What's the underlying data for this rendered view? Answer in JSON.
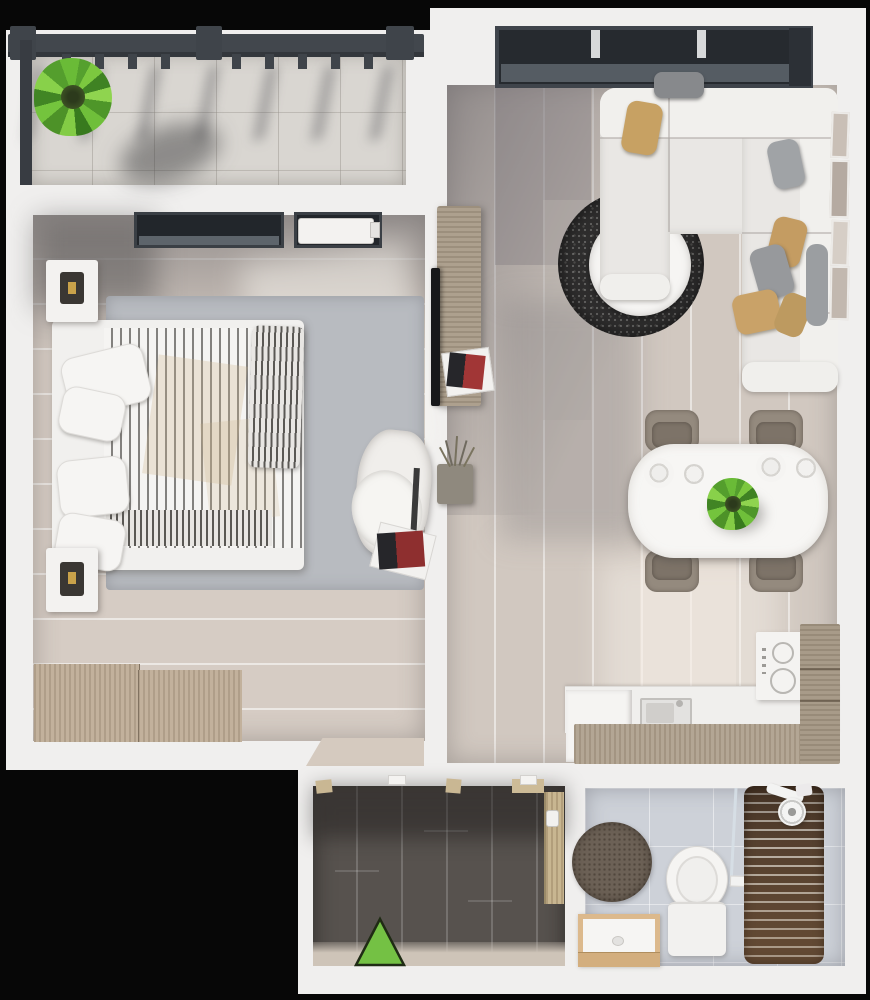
{
  "scene": {
    "kind": "3d-top-down-apartment-floor-plan",
    "background_color": "#070707",
    "wall_color": "#f0efee",
    "no_visible_text": true
  },
  "legend": {
    "entrance_marker": {
      "icon": "entrance-triangle-icon",
      "shape": "triangle-up",
      "fill": "#74c144",
      "outline": "#1f2b14"
    }
  },
  "rooms": {
    "balcony": {
      "floor_color": "#d9d6d1",
      "railing_color": "#42474d",
      "items": [
        "potted-plant",
        "railing",
        "tile-floor"
      ]
    },
    "bedroom": {
      "floor_color": "#d6ccc4",
      "rug_color": "#b8bbc0",
      "items": [
        "double-bed-striped-duvet",
        "pillows",
        "headboard",
        "nightstand-with-lamp-top",
        "nightstand-with-lamp-bottom",
        "wardrobe",
        "window-with-radiator",
        "armchair-with-throw",
        "magazine-stack"
      ]
    },
    "living_room": {
      "floor_color": "#d1c8c0",
      "items": [
        "panoramic-window",
        "corner-sofa",
        "throw-pillows-tan-and-gray",
        "round-black-rug",
        "round-white-coffee-table",
        "houseplant",
        "tv-sideboard",
        "tv",
        "decor-planter",
        "picture-frames"
      ]
    },
    "dining_area": {
      "items": [
        "white-dining-table",
        "dining-chairs-x4",
        "place-settings-x2",
        "houseplant-centerpiece"
      ]
    },
    "kitchen": {
      "items": [
        "counter",
        "sink",
        "refrigerator",
        "cooktop-two-burners",
        "wood-cabinet-front",
        "tall-cabinet"
      ]
    },
    "hallway": {
      "floor_color": "#57524e",
      "items": [
        "entrance-triangle-marker",
        "interior-door",
        "door-frame-blocks"
      ]
    },
    "bathroom": {
      "floor_color": "#cdd1d8",
      "items": [
        "round-rug",
        "wood-vanity-with-sink",
        "toilet",
        "shower-area",
        "wood-slat-shower-mat",
        "shower-head",
        "glass-partition"
      ]
    }
  },
  "accent_colors": {
    "plant_green": "#6fbf3a",
    "pillow_tan": "#c7a163",
    "sofa_white": "#e9e7e4",
    "shower_wood": "#4e3a2b",
    "vanity_wood": "#dcb98c"
  }
}
